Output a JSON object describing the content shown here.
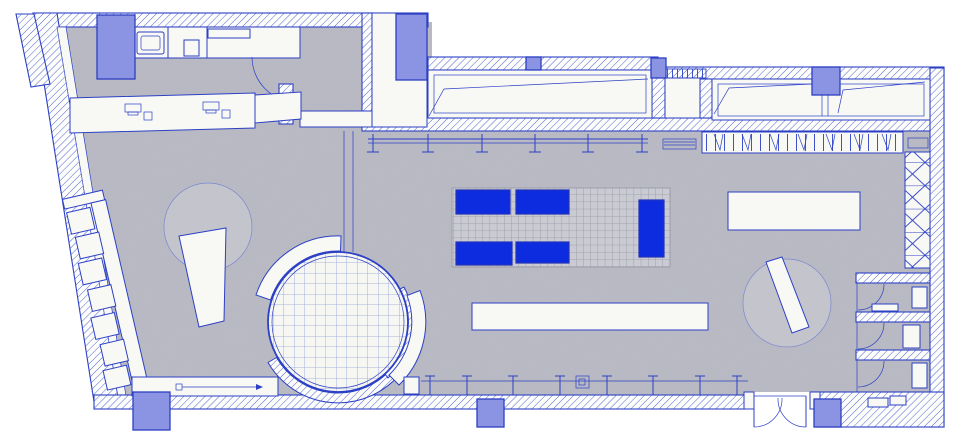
{
  "legend": {
    "title": "Retail store ground-floor plan — blueprint CAD drawing",
    "zones": [
      "washroom with sink and wc",
      "storage shelf room",
      "back corridor",
      "cash desk with two register terminals",
      "left window display with ramp",
      "right window display with ramp",
      "vestibule passage",
      "wardrobe hanger rail",
      "cross-braced shelving strip",
      "central tiled platform with blue display tables",
      "round gridded podium with curved screens",
      "west wall shelving unit",
      "long display table",
      "rotated display tables on round rugs",
      "storefront glazing with mullions",
      "double entrance door",
      "three fitting rooms with benches",
      "structural columns"
    ]
  },
  "colors": {
    "paper": "#ffffff",
    "line": "#2c40c5",
    "hatchline": "#5264d2",
    "floor": "#b9bac4",
    "floorcircle": "#c3c4cc",
    "room": "#f8f8f4",
    "platform": "#c9cad2",
    "platformgrid": "#9597a6",
    "circlegrid": "#93a1d7",
    "furniture": "#0d2ce0",
    "furnitureborder": "#2133b8",
    "column": "#8b94e2",
    "columnborder": "#2d3fc4"
  }
}
